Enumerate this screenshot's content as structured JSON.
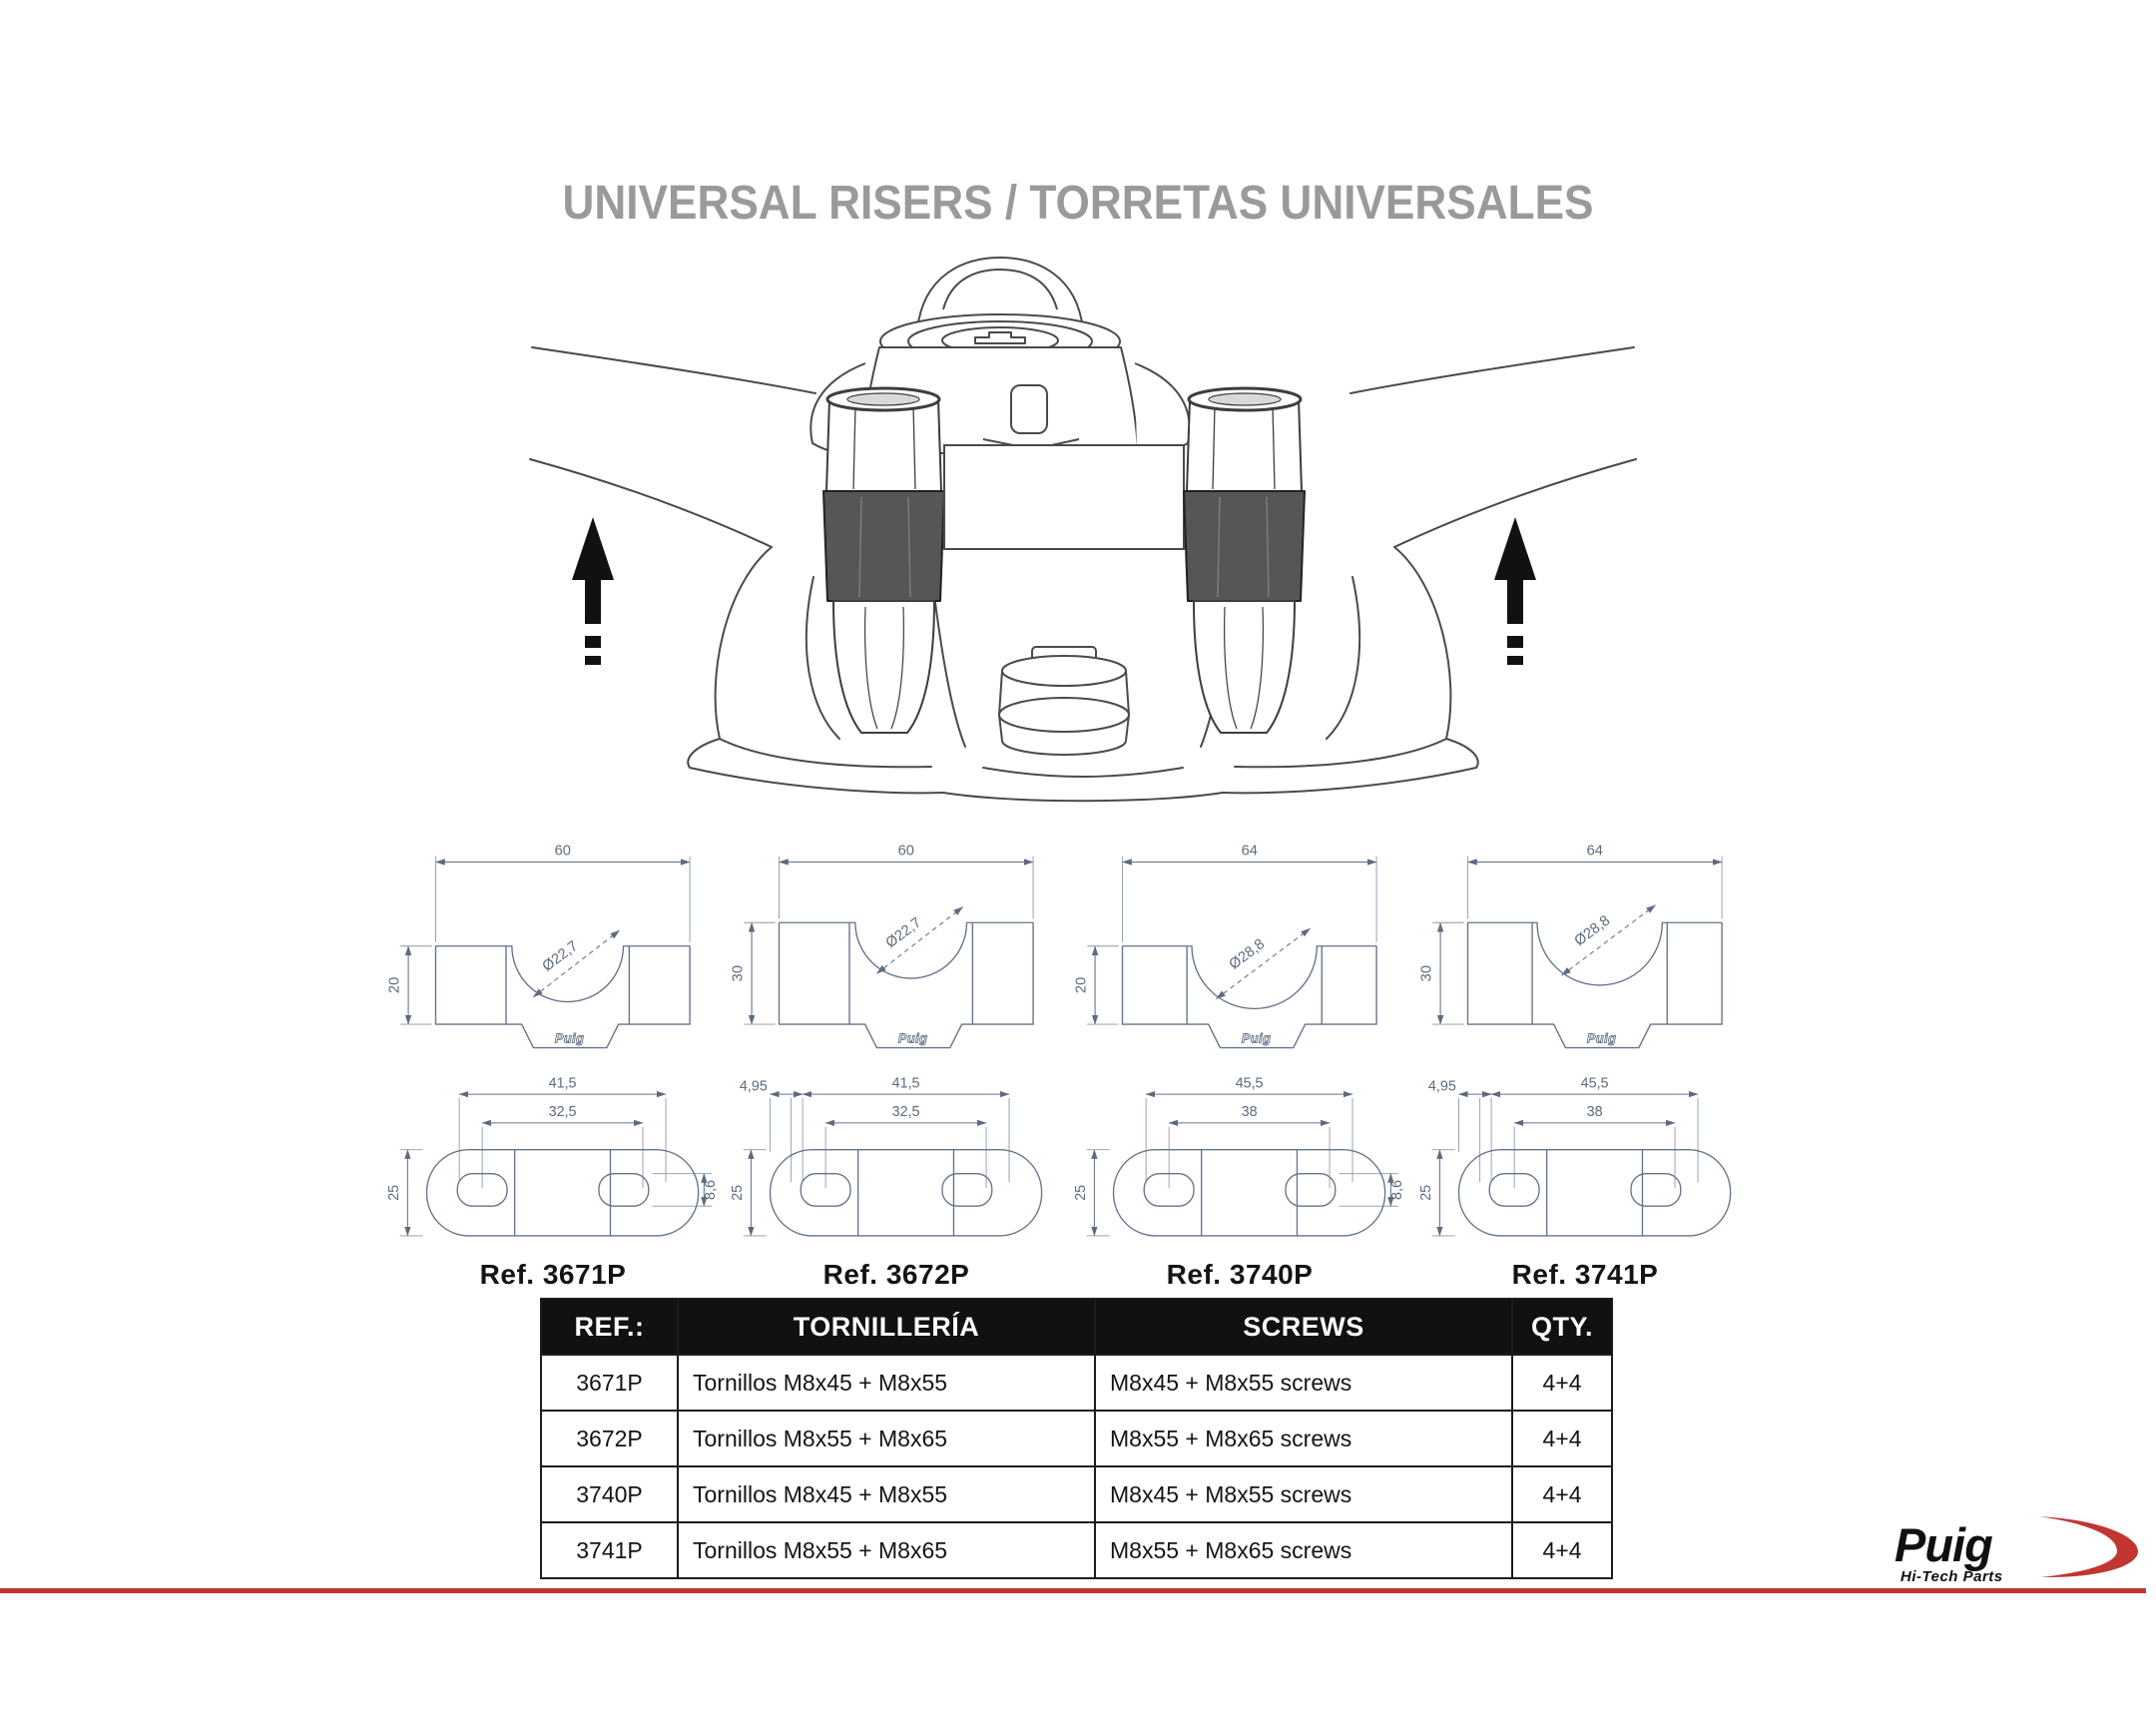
{
  "title": "UNIVERSAL RISERS / TORRETAS UNIVERSALES",
  "illustration": {
    "description": "handlebar-riser-installation-diagram",
    "left_arrow_icon": "up-arrow-icon",
    "right_arrow_icon": "up-arrow-icon"
  },
  "drawings": [
    {
      "ref": "Ref. 3671P",
      "top_width": "60",
      "height": "20",
      "diameter": "Ø22,7",
      "outer_span": "41,5",
      "inner_span": "32,5",
      "plate_depth": "25",
      "slot_width": "8,6",
      "stamp": "Puig"
    },
    {
      "ref": "Ref. 3672P",
      "top_width": "60",
      "height": "30",
      "diameter": "Ø22,7",
      "outer_span": "41,5",
      "inner_span": "32,5",
      "plate_depth": "25",
      "edge_offset": "4,95",
      "stamp": "Puig"
    },
    {
      "ref": "Ref. 3740P",
      "top_width": "64",
      "height": "20",
      "diameter": "Ø28,8",
      "outer_span": "45,5",
      "inner_span": "38",
      "plate_depth": "25",
      "slot_width": "8,6",
      "stamp": "Puig"
    },
    {
      "ref": "Ref. 3741P",
      "top_width": "64",
      "height": "30",
      "diameter": "Ø28,8",
      "outer_span": "45,5",
      "inner_span": "38",
      "plate_depth": "25",
      "edge_offset": "4,95",
      "stamp": "Puig"
    }
  ],
  "table": {
    "headers": [
      "REF.:",
      "TORNILLERÍA",
      "SCREWS",
      "QTY."
    ],
    "rows": [
      [
        "3671P",
        "Tornillos M8x45 + M8x55",
        "M8x45 + M8x55 screws",
        "4+4"
      ],
      [
        "3672P",
        "Tornillos M8x55 + M8x65",
        "M8x55 + M8x65 screws",
        "4+4"
      ],
      [
        "3740P",
        "Tornillos M8x45 + M8x55",
        "M8x45 + M8x55 screws",
        "4+4"
      ],
      [
        "3741P",
        "Tornillos M8x55 + M8x65",
        "M8x55 + M8x65 screws",
        "4+4"
      ]
    ]
  },
  "logo": {
    "brand": "Puig",
    "tagline": "Hi-Tech Parts"
  },
  "colors": {
    "accent_red": "#c13632",
    "title_gray": "#9a9a9a",
    "drawing_line": "#65738a",
    "table_header_bg": "#111111"
  }
}
